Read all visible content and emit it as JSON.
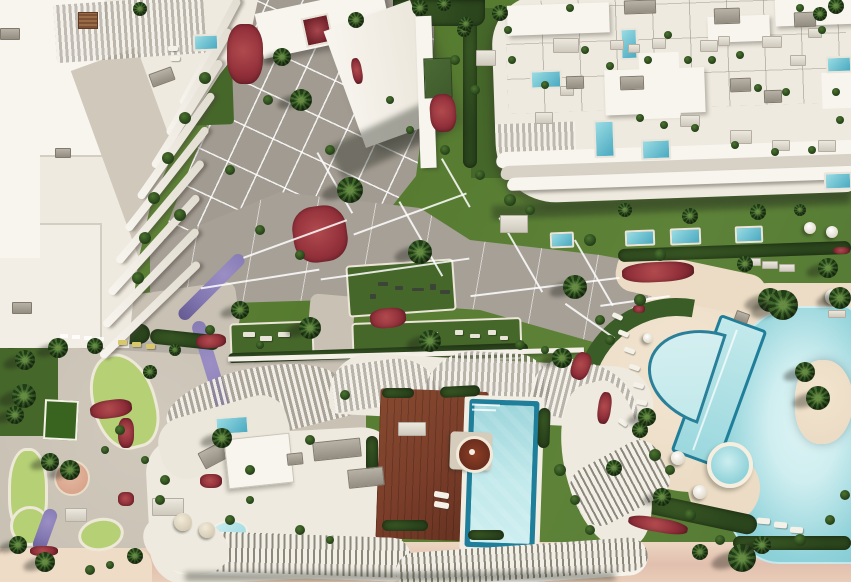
{
  "scene": {
    "description": "Aerial 3D architectural rendering of a beachfront residential resort: a curved white apartment building with rib-like terraces at top left, a long white apartment building with rooftop terraces and plunge pools at top right, a central paved promenade with palm trees and red and purple flower beds, lawns with outdoor gym equipment, a mini-golf garden at lower left, a building with rooftop wooden deck, private pool and circular spa at bottom center, a large lagoon-style swimming pool with lap lane, island and round jacuzzi at right, and a sandy beach along the bottom edge.",
    "view": "top-down aerial",
    "style": "photorealistic CGI render"
  },
  "palette": {
    "grass": "#5c8135",
    "grass-dark": "#46672a",
    "hedge": "#2b451d",
    "lawn-light": "#b5d075",
    "gravel": "#c8c1b4",
    "plaza": "#a29b91",
    "promenade": "#a7a097",
    "concrete": "#b5afa5",
    "roof-white": "#efeadf",
    "roof-bright": "#f8f5ef",
    "roof-shade": "#d8d2c6",
    "wall-line": "#c8c2b6",
    "deck-wood": "#7b3e2a",
    "pool-rim": "#1f7e99",
    "pool-light": "#c2e9eb",
    "pool-mid": "#8fd2d9",
    "lagoon-light": "#cfeef0",
    "sand-deck": "#ecdcc5",
    "sand-beach": "#e3c3ad",
    "sand-light": "#efdcc7",
    "red-flowers": "#92303a",
    "purple-flowers": "#8377b1",
    "spa-brown": "#6b2d1d",
    "umbrella-white": "#f5f0e6",
    "water-dark": "#3a8fae",
    "yellow-bed": "#d9c76b",
    "pink-planter": "#d9a58c",
    "wood-pergola": "#7d5034"
  }
}
